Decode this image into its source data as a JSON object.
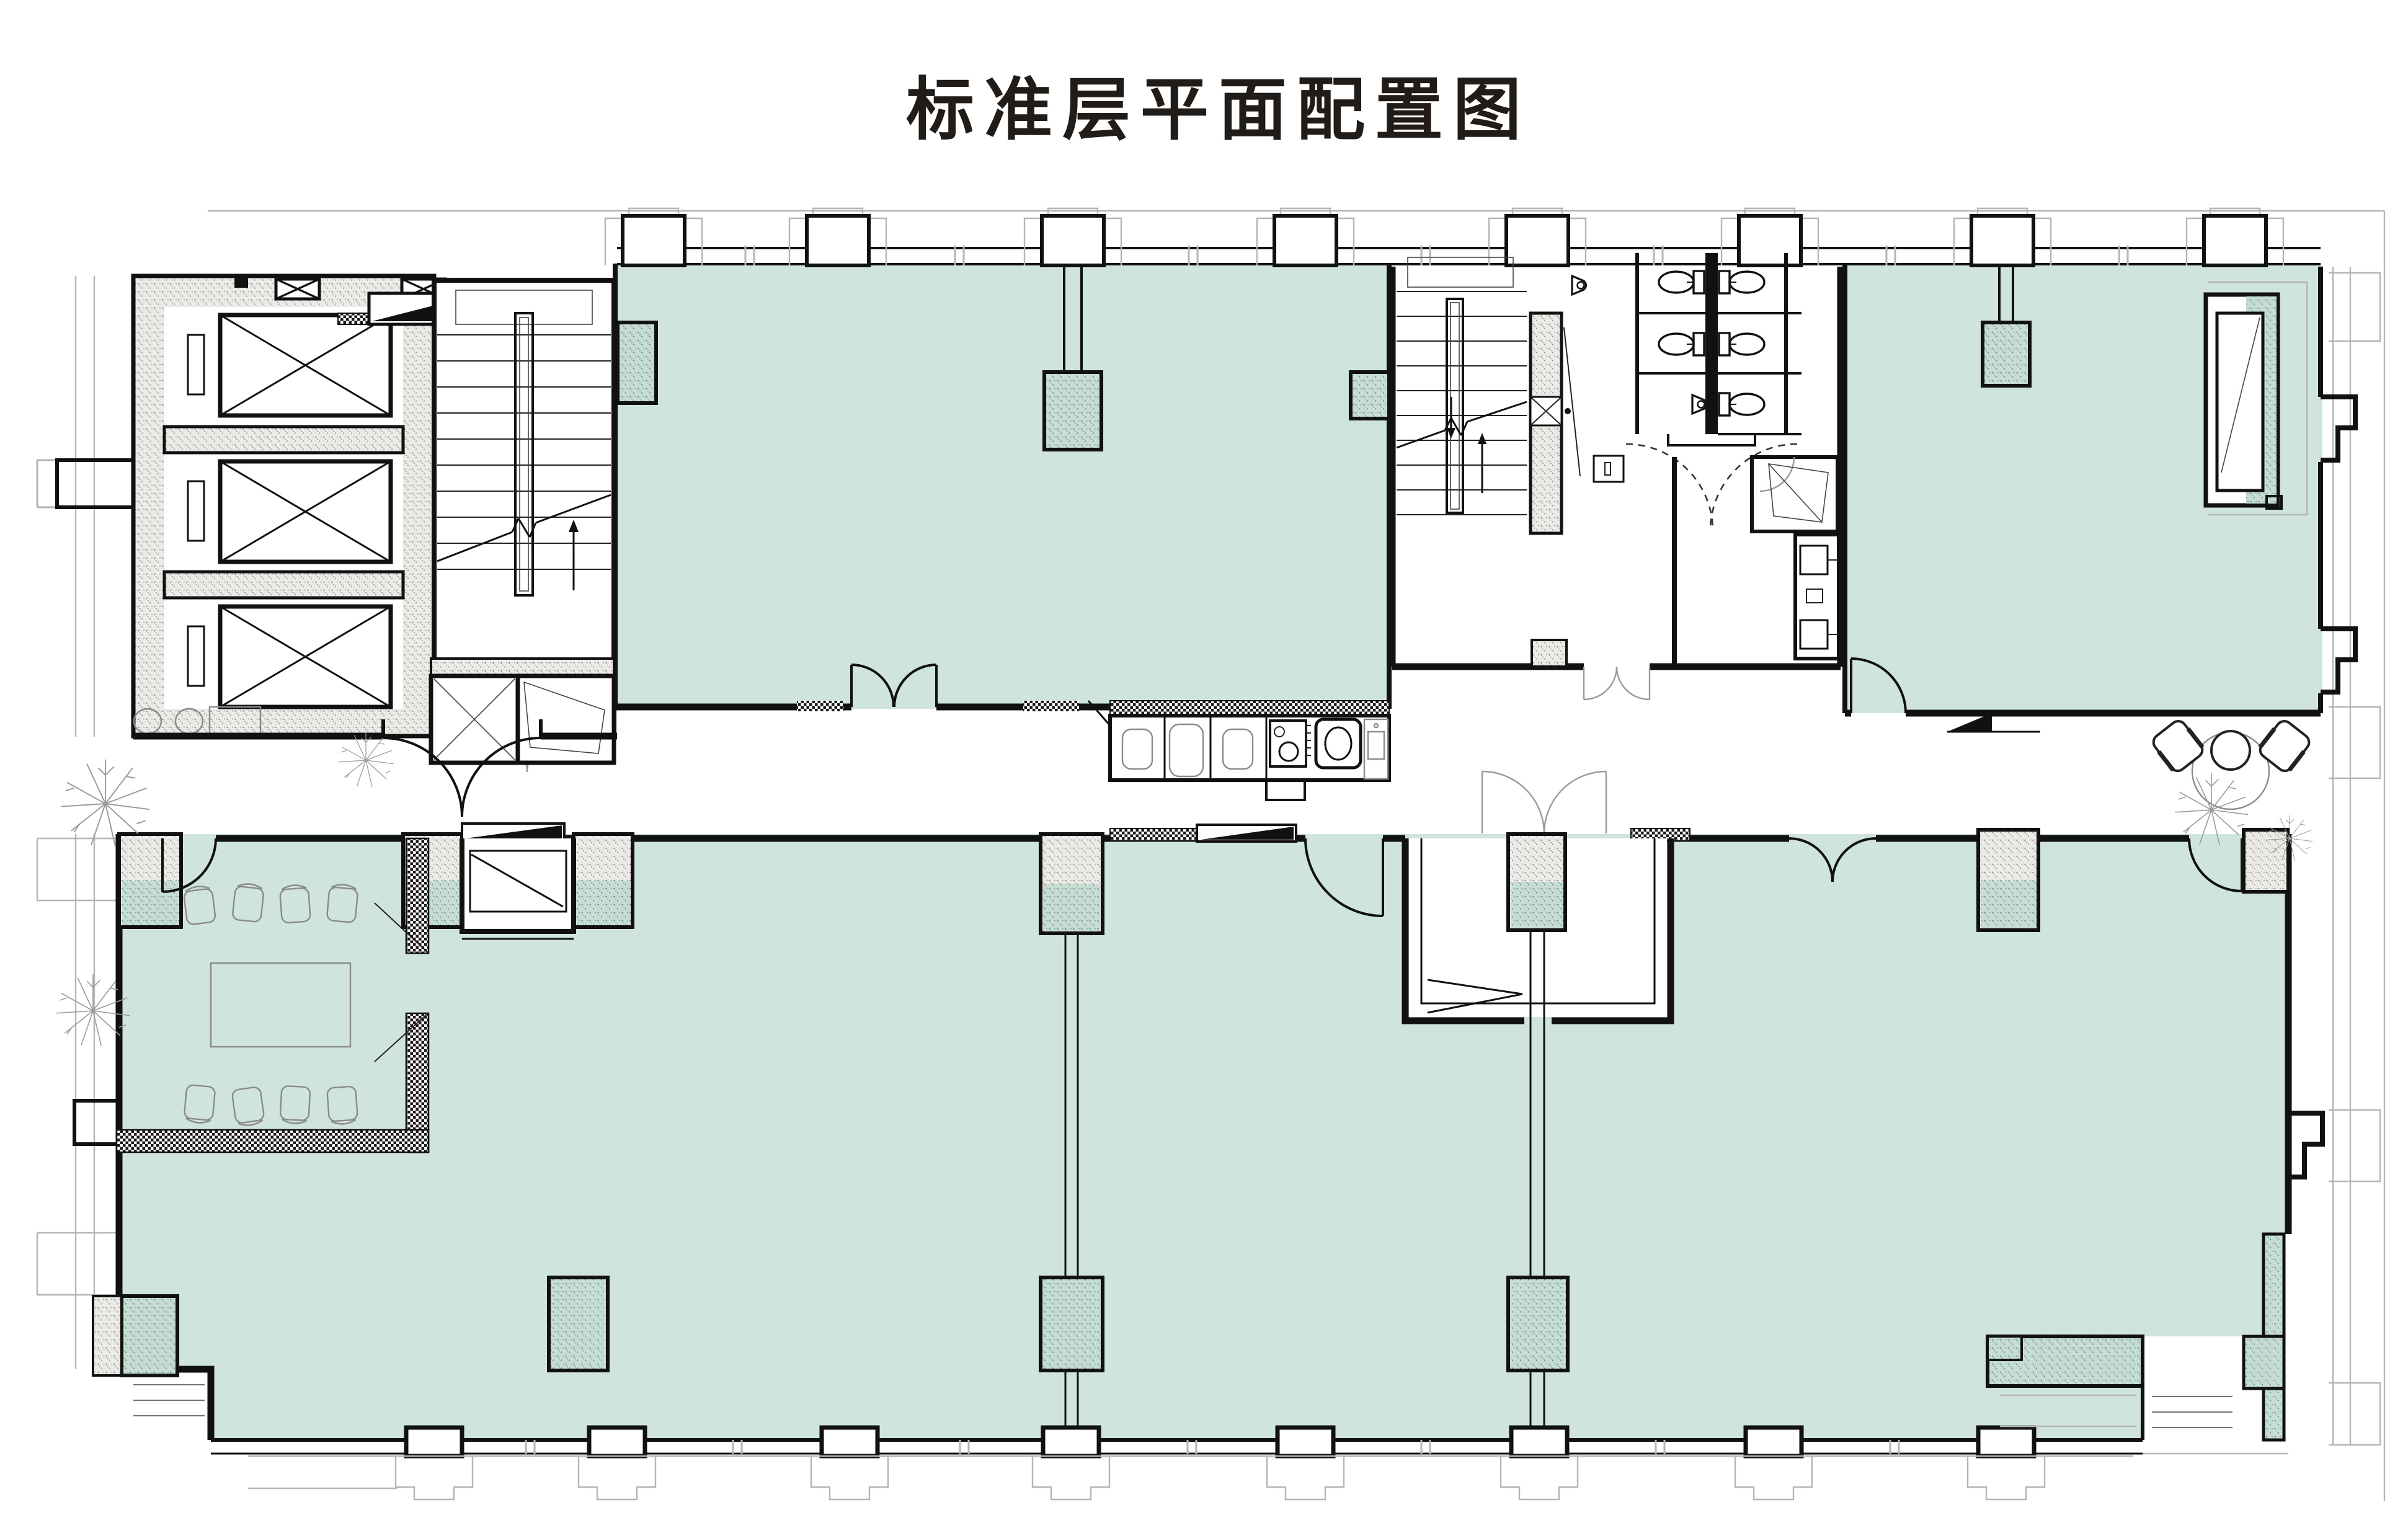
{
  "title": "标准层平面配置图",
  "palette": {
    "leasable_fill": "#cfe4db",
    "leasable_fill_dark": "#c5ddd3",
    "wall_line": "#111111",
    "hatch_bg": "#eceae6",
    "hatch_dot": "#8c8c8c",
    "checker_dark": "#1a1a1a",
    "facade_line": "#b5b5b5",
    "furniture_line": "#8a8a8a"
  },
  "plan": {
    "upper_wing": {
      "zones": [
        {
          "id": "elevator-bank",
          "elevator_shafts": 3
        },
        {
          "id": "stairwell-west",
          "flights": 2
        },
        {
          "id": "office-suite-west",
          "tinted": true,
          "columns": 3,
          "entry": "double-door",
          "pantry_fixtures": [
            "toilet",
            "tub",
            "toilet",
            "range",
            "sink",
            "counter-basin"
          ]
        },
        {
          "id": "stairwell-center",
          "flights": 2
        },
        {
          "id": "restroom-block",
          "toilets": 5,
          "urinals": 2,
          "wash_basins": 2,
          "service-room": 1
        },
        {
          "id": "office-suite-east",
          "tinted": true,
          "columns": 1,
          "service_shaft": 1,
          "level_marker": 1
        },
        {
          "id": "terrace-seating",
          "round_tables": 1,
          "armchairs": 2
        }
      ]
    },
    "lower_wing": {
      "zones": [
        {
          "id": "open-office",
          "tinted": true,
          "interior_columns": 2,
          "partition_walls": 2
        },
        {
          "id": "conference-room",
          "tables": 1,
          "chairs": 8,
          "entry": "single-door"
        },
        {
          "id": "vestibule-west",
          "ramp_marker": 1
        },
        {
          "id": "vestibule-center",
          "entry": "double-door"
        },
        {
          "id": "window-wall",
          "major_columns": 8,
          "minor_mullions": 7
        }
      ]
    },
    "landscape_trees": 5
  }
}
